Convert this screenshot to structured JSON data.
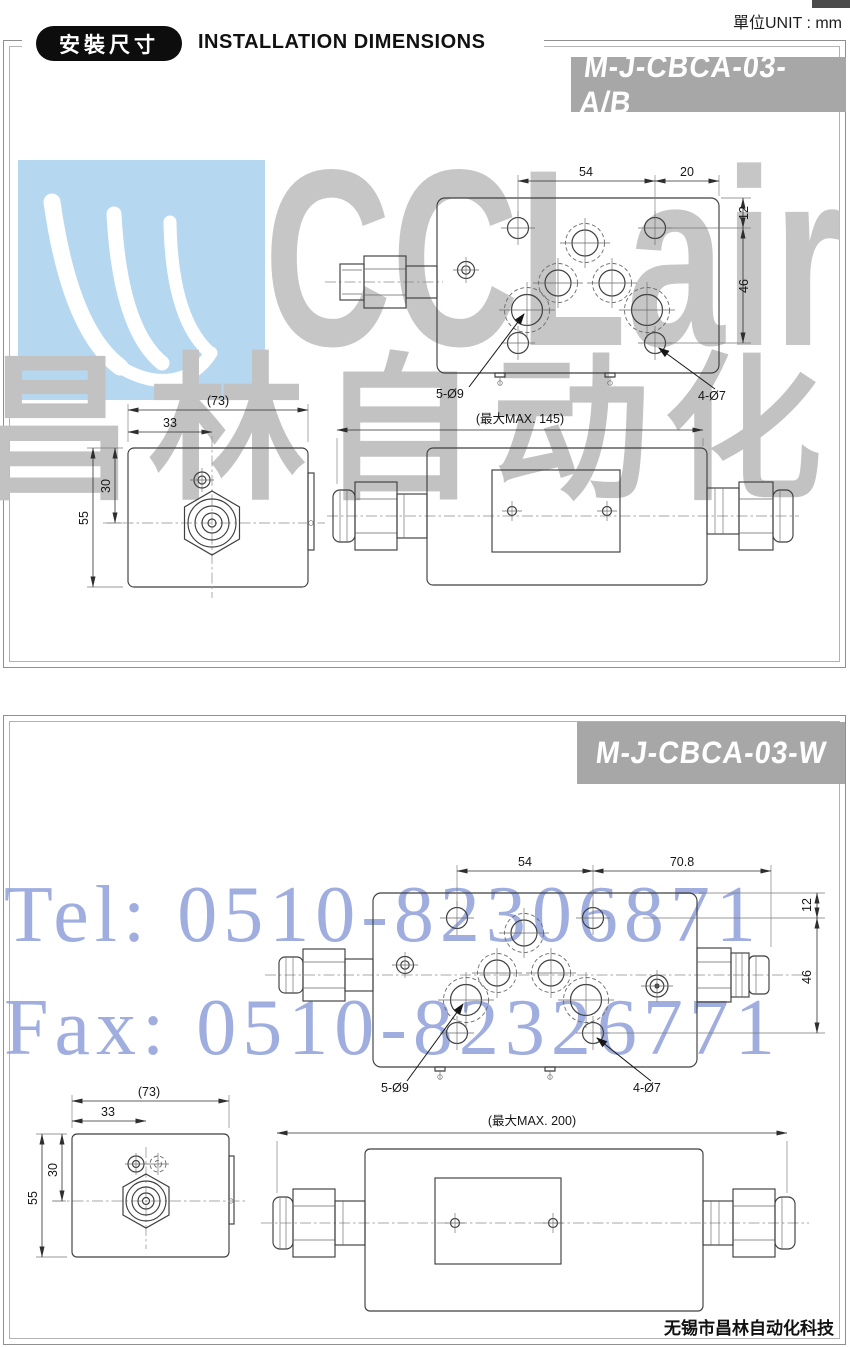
{
  "header": {
    "badge_zh": "安裝尺寸",
    "title_en": "INSTALLATION DIMENSIONS",
    "unit_label": "單位UNIT : mm"
  },
  "watermark": {
    "brand": "CCLair",
    "brand_zh": "昌林自动化",
    "tel": "Tel: 0510-82306871",
    "fax": "Fax: 0510-82326771",
    "logo_bg": "#b5d7f0",
    "gray_text_color": "#c4c4c4",
    "blue_text_color": "#8fa0da"
  },
  "footer": {
    "company": "无锡市昌林自动化科技"
  },
  "panel1": {
    "model": "M-J-CBCA-03-A/B",
    "top_view": {
      "dim_54": "54",
      "dim_20": "20",
      "dim_12": "12",
      "dim_46": "46",
      "holes_large": "5-Ø9",
      "holes_small": "4-Ø7"
    },
    "side_view": {
      "dim_73": "(73)",
      "dim_33": "33",
      "dim_30": "30",
      "dim_55": "55"
    },
    "front_view": {
      "dim_max": "(最大MAX. 145)"
    }
  },
  "panel2": {
    "model": "M-J-CBCA-03-W",
    "top_view": {
      "dim_54": "54",
      "dim_70_8": "70.8",
      "dim_12": "12",
      "dim_46": "46",
      "holes_large": "5-Ø9",
      "holes_small": "4-Ø7"
    },
    "side_view": {
      "dim_73": "(73)",
      "dim_33": "33",
      "dim_30": "30",
      "dim_55": "55"
    },
    "front_view": {
      "dim_max": "(最大MAX. 200)"
    }
  },
  "colors": {
    "badge_bg": "#a7a7a7",
    "badge_text": "#ffffff",
    "line": "#3f3f3f"
  }
}
